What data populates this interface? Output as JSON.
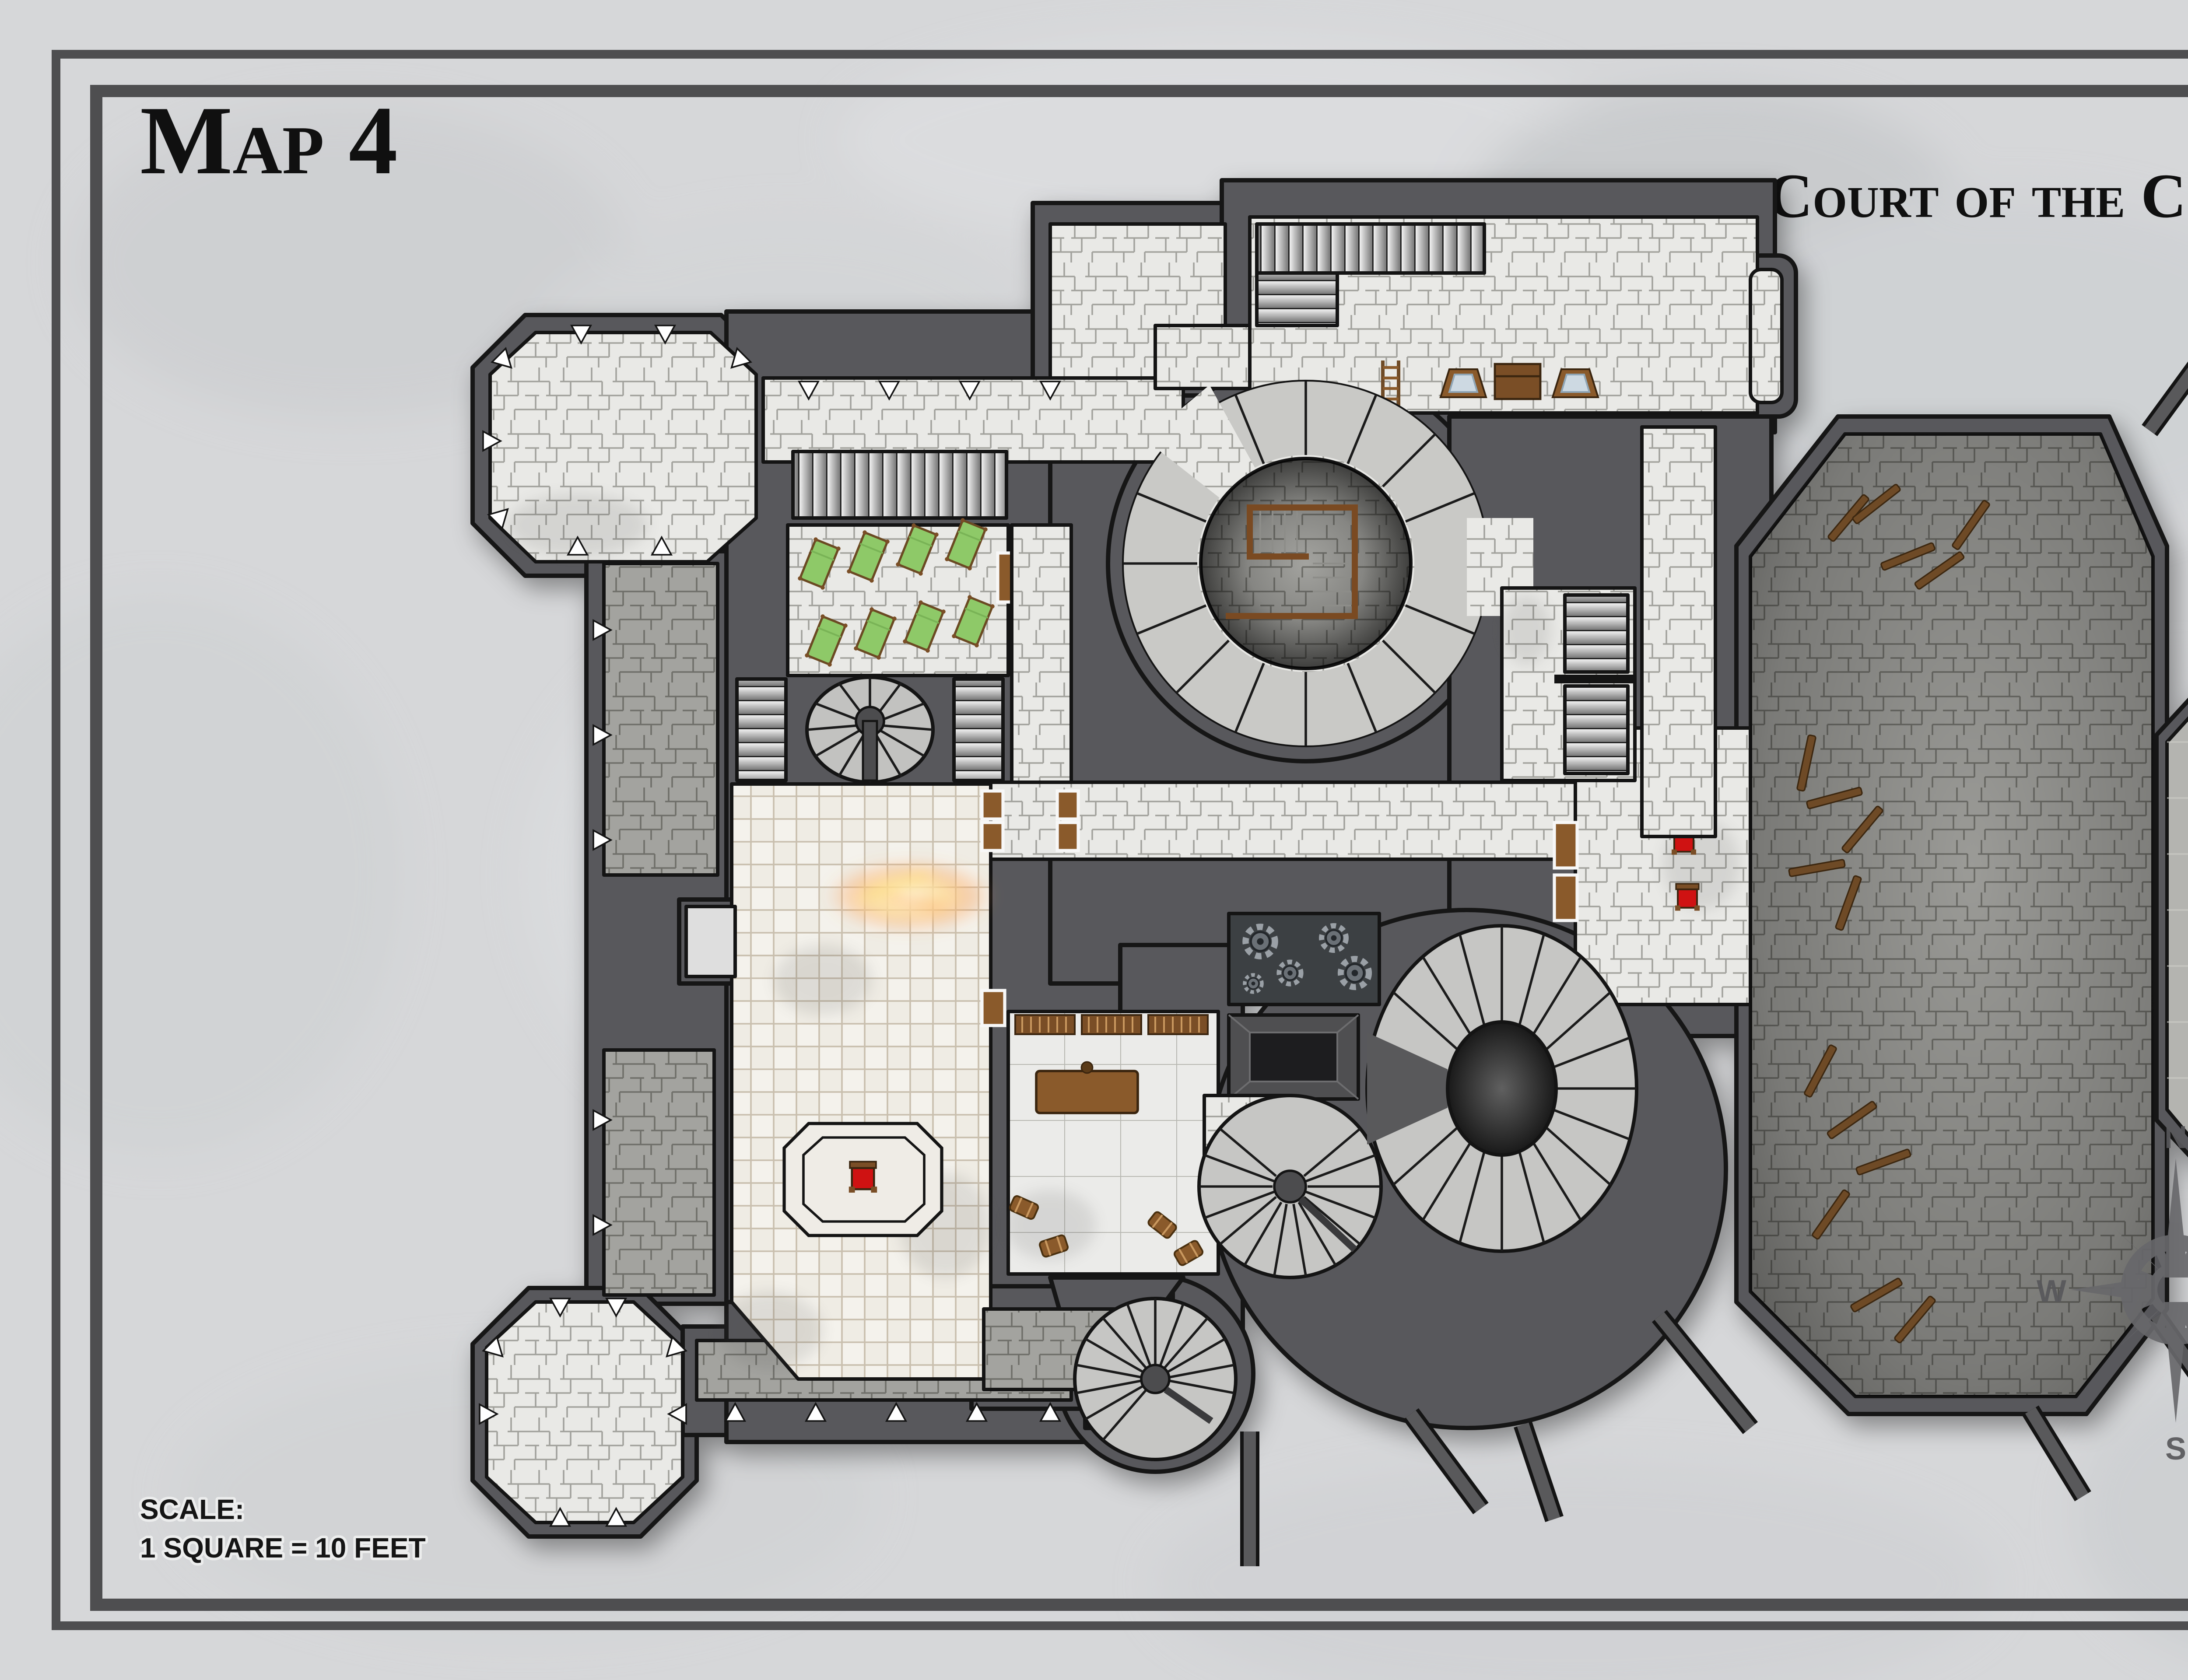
{
  "title_block": {
    "map_label": "Map 4",
    "map_name": "Court of the Count"
  },
  "scale_block": {
    "label": "SCALE:",
    "value": "1 SQUARE = 10 FEET"
  },
  "compass": {
    "north": "N",
    "east": "E",
    "south": "S",
    "west": "W"
  },
  "signature": "SCM23",
  "palette": {
    "page_bg": "#d6d7d9",
    "frame": "#4e4e50",
    "wall": "#59595b",
    "outline": "#141414",
    "floor_light": "#e9e9e6",
    "floor_dark": "#a6a6a2",
    "cot_green": "#8ec968",
    "door_brown": "#8a5a2b",
    "throne_red": "#cf1212",
    "beam_brown": "#6e4a26"
  }
}
